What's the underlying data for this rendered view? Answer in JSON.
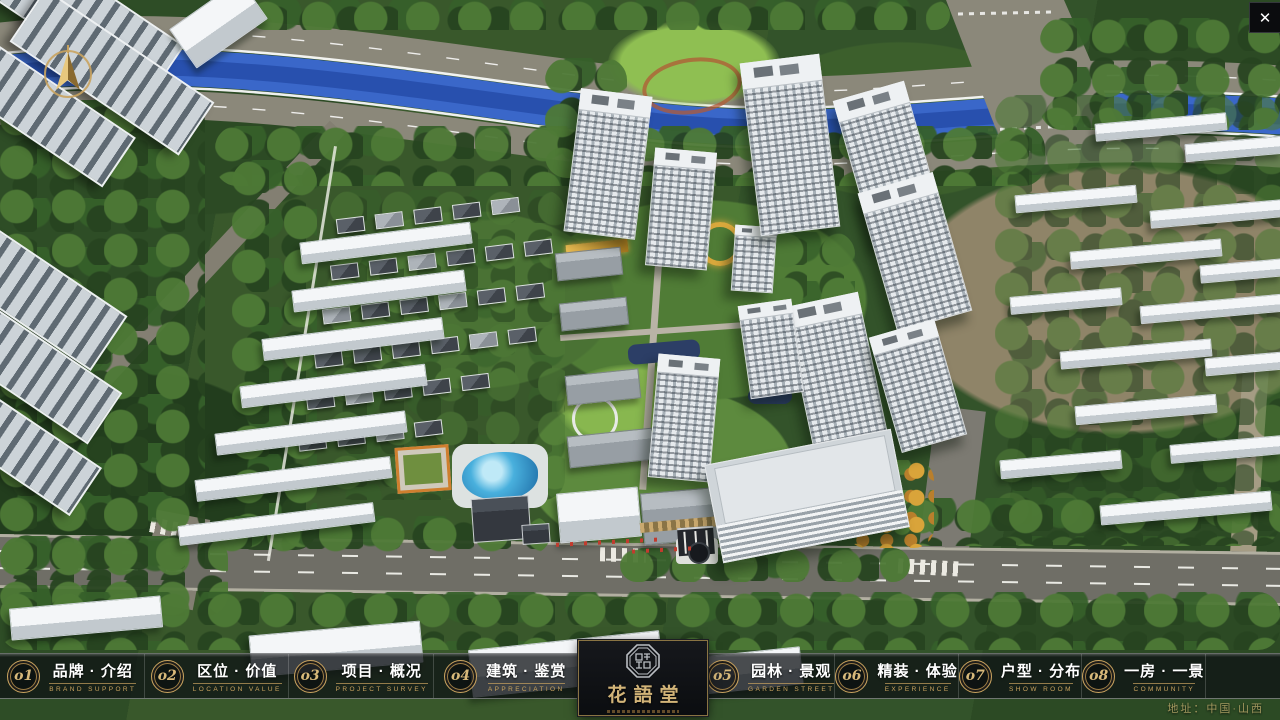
{
  "window": {
    "close_label": "✕"
  },
  "logo": {
    "title": "花語堂"
  },
  "nav": {
    "items": [
      {
        "num": "o1",
        "label": "品牌 · 介绍",
        "sub": "BRAND SUPPORT"
      },
      {
        "num": "o2",
        "label": "区位 · 价值",
        "sub": "LOCATION VALUE"
      },
      {
        "num": "o3",
        "label": "项目 · 概况",
        "sub": "PROJECT SURVEY"
      },
      {
        "num": "o4",
        "label": "建筑 · 鉴赏",
        "sub": "APPRECIATION"
      },
      {
        "num": "o5",
        "label": "园林 · 景观",
        "sub": "GARDEN STREET"
      },
      {
        "num": "o6",
        "label": "精装 · 体验",
        "sub": "EXPERIENCE"
      },
      {
        "num": "o7",
        "label": "户型 · 分布",
        "sub": "SHOW ROOM"
      },
      {
        "num": "o8",
        "label": "一房 · 一景",
        "sub": "COMMUNITY"
      }
    ]
  },
  "footer": {
    "address": "地址：中国·山西"
  },
  "colors": {
    "gold_accent": "#c9a35f",
    "river_blue": "#3a67c9",
    "flag_red": "#c23b2e",
    "bar_background": "rgba(14,16,20,0.74)"
  }
}
